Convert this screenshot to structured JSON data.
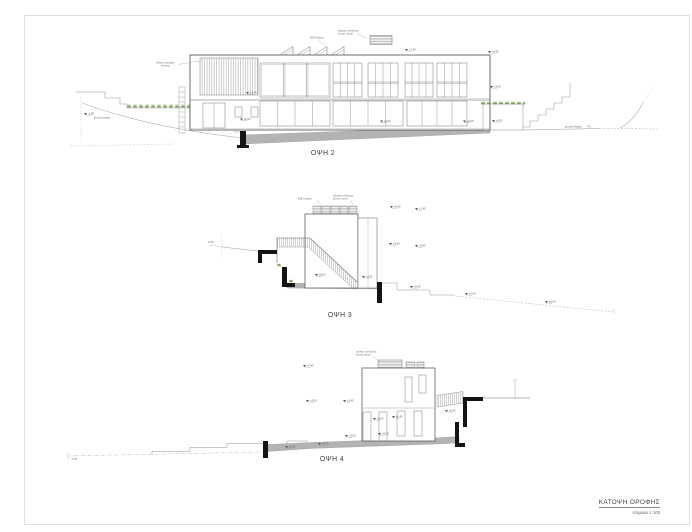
{
  "sheet": {
    "title": "ΚΑΤΟΨΗ ΟΡΟΦΗΣ",
    "scale": "Κλίμακα 1:100"
  },
  "elevations": [
    {
      "label": "ΟΨΗ 2"
    },
    {
      "label": "ΟΨΗ 3"
    },
    {
      "label": "ΟΨΗ 4"
    }
  ],
  "annotations": {
    "pv": "Φ/Β πλαίσια",
    "collector1": "ηλιακός συλλέκτης",
    "collector2": "ζεστού νερού",
    "louvers1": "ξύλινες περσίδες",
    "louvers2": "σκίασης",
    "ground": "φυσικό έδαφος",
    "slope_left": "2.5%",
    "slope_right": "7%"
  },
  "levels": {
    "l745": "+7.45",
    "l695": "+6.95",
    "l395": "+3.95",
    "l345": "+3.45",
    "l045": "+0.45",
    "l005": "+0.05",
    "l000": "±0.00",
    "lm280": "-2.80",
    "lm745": "-7.45"
  },
  "colors": {
    "line": "#6f6f6f",
    "outline": "#4a4a4a",
    "ground_fill": "#b3b3b3",
    "wall_fill": "#141414",
    "planting": "#87a065",
    "frame": "#e0e0e0"
  }
}
